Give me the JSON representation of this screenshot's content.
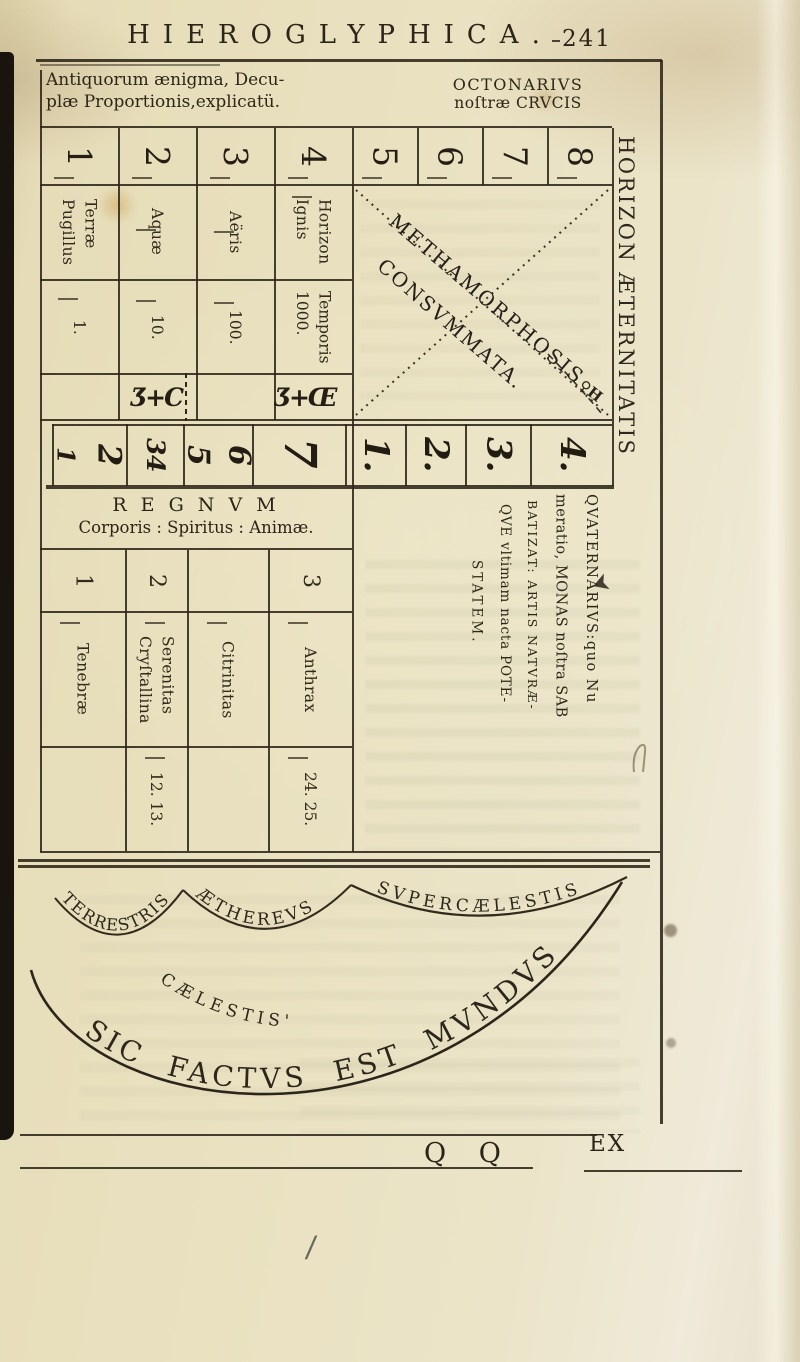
{
  "header": {
    "title": "HIEROGLYPHICA.",
    "page_number": "241"
  },
  "captions": {
    "left1": "Antiquorum ænigma, Decu-",
    "left2": "plæ Proportionis,explicatü.",
    "right1": "OCTONARIVS",
    "right2": "noſtræ CRVCIS"
  },
  "table1": {
    "numerals": [
      "1",
      "2",
      "3",
      "4"
    ],
    "labels": [
      [
        "Terræ",
        "Pugillus"
      ],
      [
        "Aquæ"
      ],
      [
        "Aëris"
      ],
      [
        "Horizon",
        "Ignis"
      ]
    ],
    "values": [
      [
        "1."
      ],
      [
        "10."
      ],
      [
        "100."
      ],
      [
        "Temporis",
        "1000."
      ]
    ],
    "symbols": [
      "Ʒ+C",
      "Ʒ+Œ"
    ]
  },
  "octonarius": {
    "numerals": [
      "5",
      "6",
      "7",
      "8"
    ],
    "diag1": "METHAMORPHOSIS",
    "diag2": "CONSVMMATA.",
    "corner_symbol": "♀H"
  },
  "glyph_row": [
    "1",
    "2",
    "3",
    "4",
    "5",
    "6",
    "7",
    "1.",
    "2.",
    "3.",
    "4."
  ],
  "table2": {
    "title": "R E G N V M",
    "subtitle": "Corporis : Spiritus : Animæ.",
    "numerals": [
      "1",
      "2",
      "",
      "3"
    ],
    "labels": [
      [
        "Tenebræ"
      ],
      [
        "Serenitas",
        "Cryſtallina"
      ],
      [
        "Citrinitas"
      ],
      [
        "Anthrax"
      ]
    ],
    "values": [
      "",
      "12. 13.",
      "",
      "24. 25."
    ]
  },
  "quaternarius": {
    "line1": "QVATERNARIVS:quo Nu",
    "line2": "meratio, MONAS noſtra SAB",
    "line3": "BATIZAT: ARTIS NATVRÆ-",
    "line4": "QVE vltimam nacta POTE-",
    "line5": "STATEM."
  },
  "margin": {
    "vertical_title": "HORIZON ÆTERNITATIS"
  },
  "diagram": {
    "arc_terrestris": "TERRESTRIS",
    "arc_aethereus": "ÆTHEREVS",
    "arc_supercaelestis": "SVPERCÆLESTIS",
    "arc_caelestis": "CÆLESTIS'",
    "arc_main": "SIC FACTVS EST MVNDVS"
  },
  "footer": {
    "signature": "Q Q",
    "catchword": "EX"
  },
  "marks": {
    "slash": "/"
  }
}
